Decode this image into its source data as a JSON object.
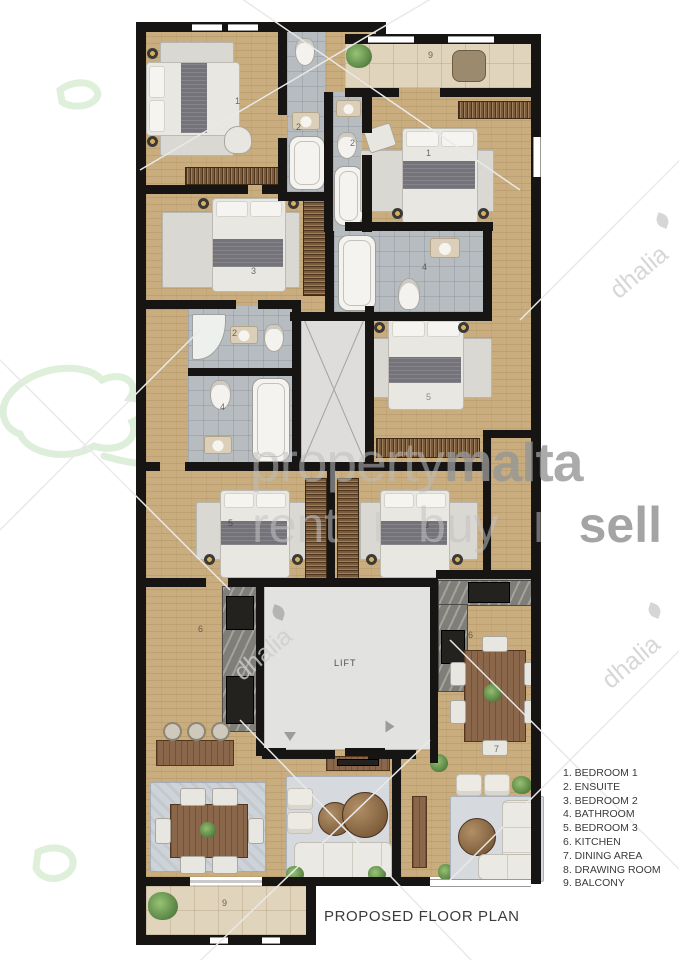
{
  "plan": {
    "title": "PROPOSED FLOOR PLAN",
    "lift_label": "LIFT",
    "room_numbers": {
      "bedroom1_left": "1",
      "ensuite_left_a": "2",
      "ensuite_left_b": "2",
      "balcony_top": "9",
      "bedroom1_right": "1",
      "bedroom2_left": "3",
      "bathroom_right": "4",
      "ensuite_mid": "2",
      "bathroom_mid": "4",
      "bedroom3_mid_right": "5",
      "bedroom3_left": "5",
      "bedroom2_right": "3",
      "kitchen_left": "6",
      "kitchen_right": "6",
      "dining_right": "7",
      "balcony_bottom": "9"
    }
  },
  "legend": {
    "items": [
      "1. BEDROOM 1",
      "2. ENSUITE",
      "3. BEDROOM 2",
      "4. BATHROOM",
      "5. BEDROOM 3",
      "6. KITCHEN",
      "7. DINING AREA",
      "8. DRAWING ROOM",
      "9. BALCONY"
    ]
  },
  "watermarks": {
    "brand_light": "property",
    "brand_bold": "malta",
    "tagline": [
      "rent",
      "buy",
      "sell"
    ],
    "tagline_separator": "I",
    "agency": "dhalia"
  },
  "colors": {
    "floor": "#c9ad7e",
    "wall": "#161514",
    "bath_tile": "#b7bcc0",
    "balcony_tile": "#e0d4bc",
    "lift": "#e2e2e0",
    "wardrobe": "#7b5a3a",
    "counter_marble": "#7f7e78",
    "appliance": "#23221e",
    "wood": "#8a674a",
    "rug_blue": "#ccd3da",
    "watermark_gray": "#c8c8c8",
    "logo_green": "#d8ecd4"
  }
}
